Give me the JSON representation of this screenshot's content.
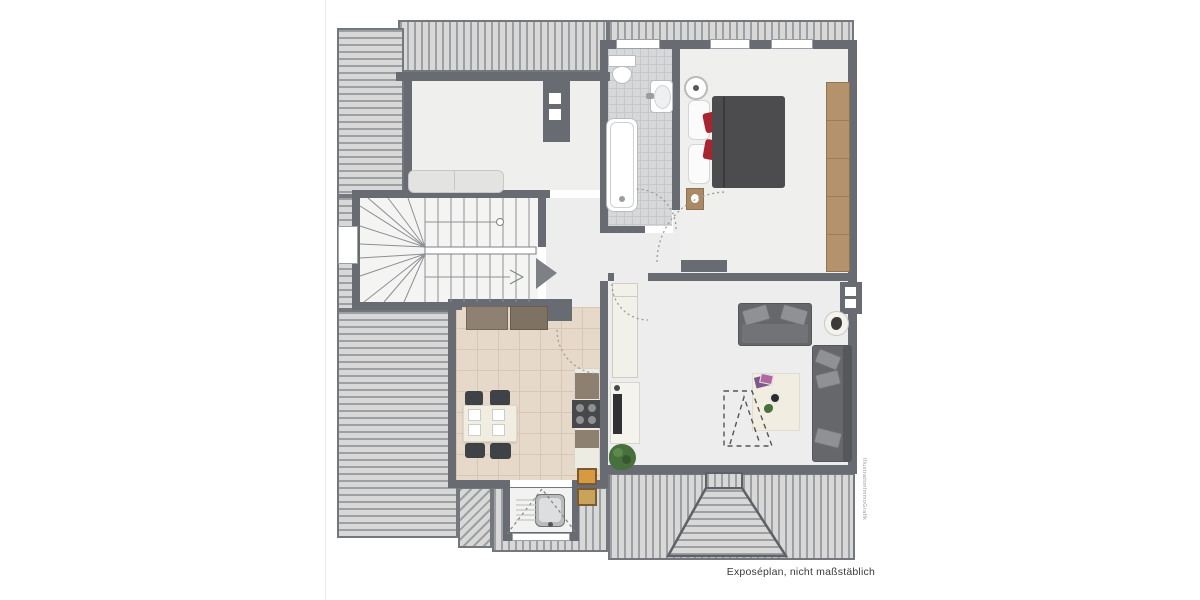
{
  "caption": {
    "text": "Exposéplan, nicht maßstäblich"
  },
  "watermark": {
    "text": "IllustrationImmoGrafik"
  },
  "palette": {
    "wall": "#686c72",
    "hatch_background": "#d8d8d8",
    "hatch_stripe": "#9da0a2",
    "room_floor": "#efefee",
    "bath_tile": "#d7d8d9",
    "kitchen_tile": "#e6d9ca",
    "wood": "#b3926c",
    "sofa_gray": "#65676a",
    "bed_duvet": "#4c4c4e",
    "accent_red": "#a8242f",
    "rug": "#f1eee1",
    "plant_green": "#47703c"
  },
  "rooms": [
    {
      "name": "studio-room"
    },
    {
      "name": "stairwell"
    },
    {
      "name": "hallway"
    },
    {
      "name": "bathroom"
    },
    {
      "name": "bedroom"
    },
    {
      "name": "kitchen-dining"
    },
    {
      "name": "living-room"
    }
  ],
  "furniture": [
    "staircase",
    "bench",
    "chimney",
    "toilet",
    "washbasin",
    "bathtub",
    "double-bed",
    "red-cushions",
    "nightstand",
    "bedside-lamp",
    "wardrobe",
    "two-seat-sofa",
    "corner-sofa",
    "side-table-plant",
    "rug",
    "coffee-table-magazines",
    "loft-ladder-outline",
    "tv-lowboard",
    "tall-cabinet",
    "kitchen-counter",
    "stove",
    "dining-table",
    "dining-chairs",
    "kitchen-sink-dormer",
    "plant",
    "roof-dormer"
  ]
}
